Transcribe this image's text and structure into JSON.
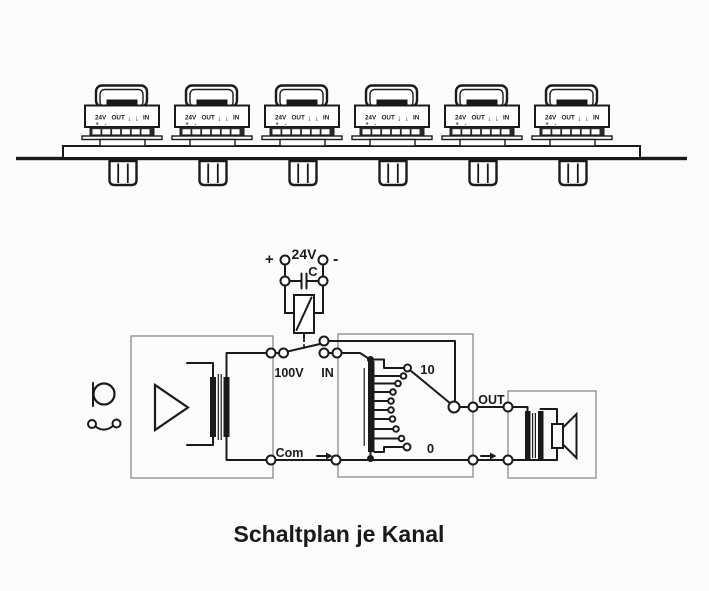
{
  "title": "Schaltplan je Kanal",
  "top_assembly": {
    "module_count": 6,
    "module_label": {
      "voltage": "24V",
      "plus": "+",
      "minus": "-",
      "out": "OUT",
      "arrow_down": "↓",
      "in": "IN"
    }
  },
  "schematic": {
    "supply": {
      "plus": "+",
      "voltage": "24V",
      "minus": "-",
      "capacitor": "C"
    },
    "switch": {
      "bus_label": "100V",
      "input_label": "IN"
    },
    "common_label": "Com",
    "output_label": "OUT",
    "selector": {
      "max_tap": "10",
      "min_tap": "0"
    }
  },
  "colors": {
    "line": "#1a1a1a",
    "box_outline": "#808080",
    "background": "#fcfcfc"
  }
}
